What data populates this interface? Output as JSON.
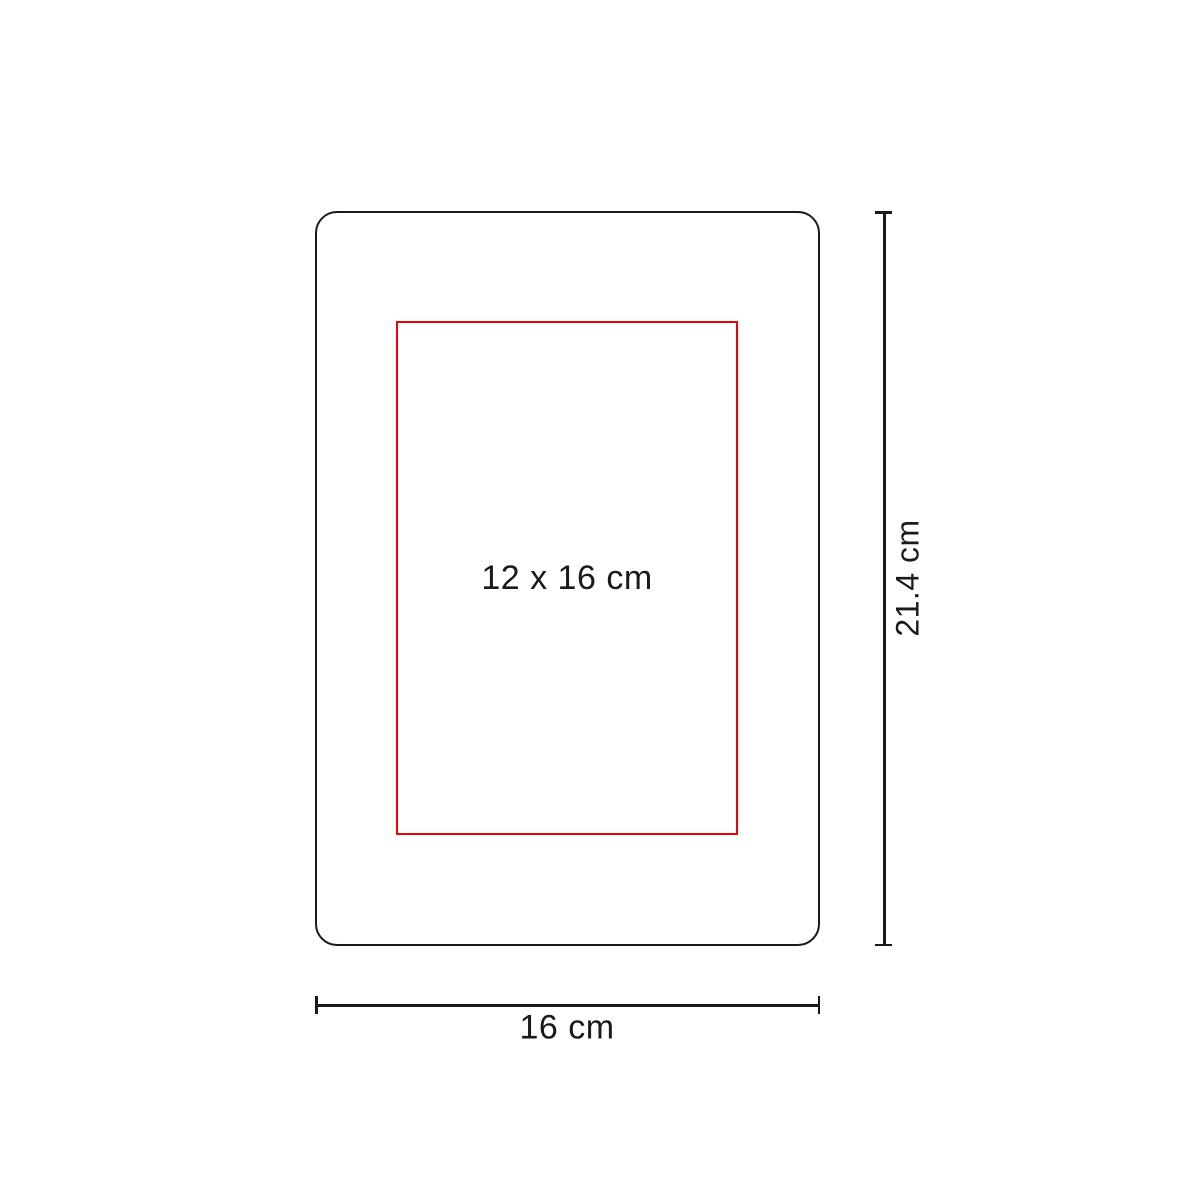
{
  "diagram": {
    "colors": {
      "bg": "#ffffff",
      "ink": "#1a1a1a",
      "accent": "#f40000"
    },
    "print_area": {
      "label": "12 x 16 cm"
    },
    "height_dimension": {
      "label": "21.4 cm"
    },
    "width_dimension": {
      "label": "16 cm"
    }
  }
}
